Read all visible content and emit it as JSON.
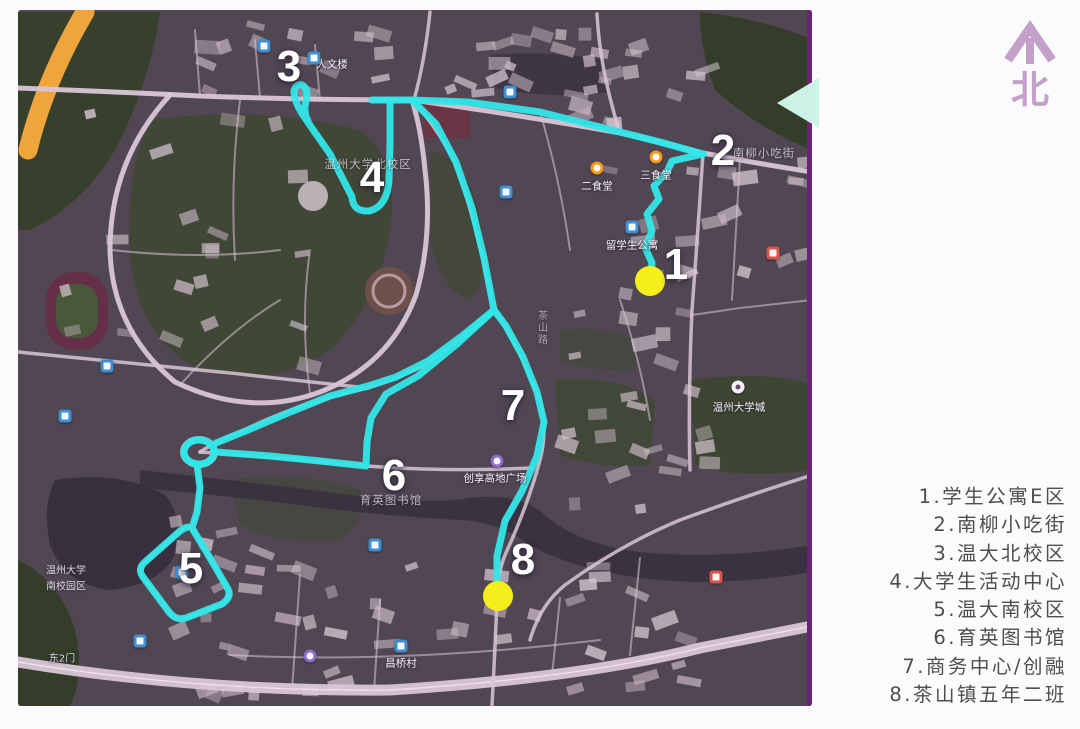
{
  "title": "校园路线示意图",
  "north": {
    "label": "北",
    "color": "#c2a0c8"
  },
  "legend": {
    "items": [
      "1.学生公寓E区",
      "2.南柳小吃街",
      "3.温大北校区",
      "4.大学生活动中心",
      "5.温大南校区",
      "6.育英图书馆",
      "7.商务中心/创融",
      "8.茶山镇五年二班"
    ]
  },
  "map": {
    "route_color": "#31e6e8",
    "dot_color": "#f6ee1b",
    "marker_color": "#ffffff",
    "routes": [
      "M650,281 L652,263 L645,247 L652,231 L647,214 L659,199 L654,186 L667,172 L672,161 L703,154",
      "M703,154 L660,142 L620,132 L540,112 L468,102 L412,100 L372,100",
      "M390,103 L390,145 L389,180 Q387,207 369,211 Q353,212 352,197 L330,154 L316,134 L303,115 Q294,101 294,91 Q296,83 302,85 Q309,89 306,101 Q303,112 308,121",
      "M412,100 L436,124 L456,162 L472,208 L484,258 L494,310",
      "M494,310 L506,326 L523,357 L537,392 L544,422 L537,456 L522,491 L505,521 L497,556 L497,592",
      "M494,310 L462,336 L428,361 L396,377 L368,386 L330,396 L288,413 L248,430 L216,443",
      "M494,310 L457,344 L418,376 L386,394 L371,418 L367,442 L366,466 L320,461 L270,456 L216,452",
      "M197,464 L200,488 L197,512 L192,528 L210,558 L228,589 Q232,597 222,604 L186,618 Q176,621 169,612 L143,577 Q137,569 145,562 L180,531 Q188,525 192,528"
    ],
    "roundabout": {
      "cx": 199,
      "cy": 452,
      "rx": 15,
      "ry": 12
    },
    "dots": [
      {
        "x": 650,
        "y": 281,
        "r": 15
      },
      {
        "x": 498,
        "y": 596,
        "r": 15
      }
    ],
    "markers": [
      {
        "label": "1",
        "x": 676,
        "y": 265
      },
      {
        "label": "2",
        "x": 723,
        "y": 151
      },
      {
        "label": "3",
        "x": 289,
        "y": 67
      },
      {
        "label": "4",
        "x": 372,
        "y": 178
      },
      {
        "label": "5",
        "x": 191,
        "y": 569
      },
      {
        "label": "6",
        "x": 394,
        "y": 476
      },
      {
        "label": "7",
        "x": 513,
        "y": 406
      },
      {
        "label": "8",
        "x": 523,
        "y": 560
      }
    ],
    "pois": [
      {
        "text": "人文楼",
        "x": 332,
        "y": 64,
        "badge": "blue",
        "bx": 314,
        "by": 58
      },
      {
        "text": "二食堂",
        "x": 597,
        "y": 186,
        "badge": "orange",
        "bx": 597,
        "by": 168
      },
      {
        "text": "三食堂",
        "x": 656,
        "y": 175,
        "badge": "orange",
        "bx": 656,
        "by": 157
      },
      {
        "text": "留学生公寓",
        "x": 632,
        "y": 245,
        "badge": "blue",
        "bx": 632,
        "by": 227
      },
      {
        "text": "温州大学北校区",
        "x": 368,
        "y": 164,
        "style": "wm"
      },
      {
        "text": "南柳小吃街",
        "x": 764,
        "y": 153,
        "style": "wm"
      },
      {
        "text": "育英图书馆",
        "x": 391,
        "y": 500,
        "style": "wm"
      },
      {
        "text": "创享高地广场",
        "x": 495,
        "y": 478,
        "badge": "purple",
        "bx": 497,
        "by": 461
      },
      {
        "text": "温州大学",
        "x": 66,
        "y": 569,
        "style": "wm2"
      },
      {
        "text": "南校园区",
        "x": 66,
        "y": 585,
        "style": "wm2"
      },
      {
        "text": "温州大学城",
        "x": 739,
        "y": 407,
        "badge": "white",
        "bx": 738,
        "by": 387
      },
      {
        "text": "昌桥村",
        "x": 401,
        "y": 663,
        "badge": "blue",
        "bx": 401,
        "by": 646
      },
      {
        "text": "东2门",
        "x": 62,
        "y": 657,
        "style": "wm2"
      },
      {
        "text": "茶山路",
        "x": 541,
        "y": 328,
        "style": "vert"
      }
    ],
    "badges_extra": [
      {
        "badge": "red",
        "bx": 773,
        "by": 253
      },
      {
        "badge": "blue",
        "bx": 264,
        "by": 46
      },
      {
        "badge": "blue",
        "bx": 510,
        "by": 92
      },
      {
        "badge": "blue",
        "bx": 506,
        "by": 192
      },
      {
        "badge": "blue",
        "bx": 107,
        "by": 366
      },
      {
        "badge": "blue",
        "bx": 65,
        "by": 416
      },
      {
        "badge": "blue",
        "bx": 182,
        "by": 572
      },
      {
        "badge": "blue",
        "bx": 140,
        "by": 641
      },
      {
        "badge": "blue",
        "bx": 375,
        "by": 545
      },
      {
        "badge": "purple",
        "bx": 310,
        "by": 656
      },
      {
        "badge": "red",
        "bx": 716,
        "by": 577
      }
    ]
  }
}
